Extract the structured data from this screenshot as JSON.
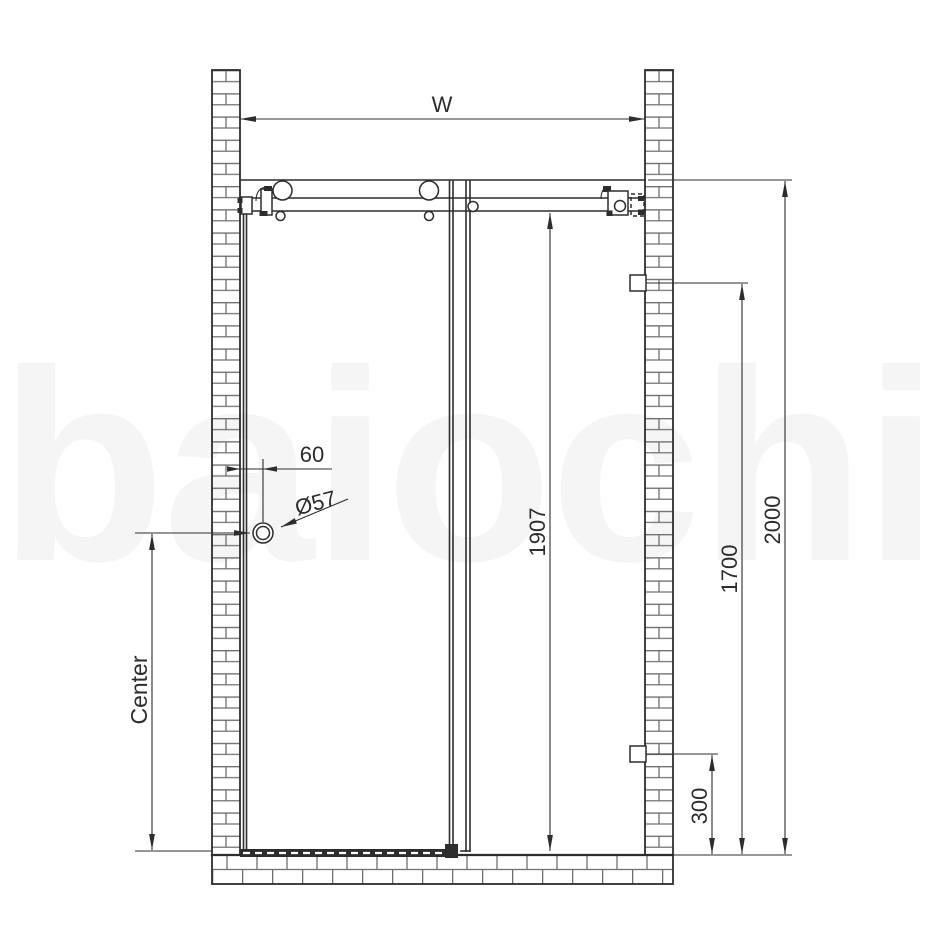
{
  "watermark": "baiochi",
  "labels": {
    "width": "W",
    "overall_height": "2000",
    "upper_bracket_height": "1700",
    "door_glass_height": "1907",
    "lower_bracket_height": "300",
    "handle_center": "Center",
    "handle_wall_offset": "60",
    "handle_diameter": "Ø57"
  },
  "colors": {
    "page_bg": "#ffffff",
    "line": "#2d2d2d",
    "brick_joint": "#6f6f6f",
    "dimension": "#2d2d2d",
    "watermark_fill": "#f5f5f5"
  }
}
